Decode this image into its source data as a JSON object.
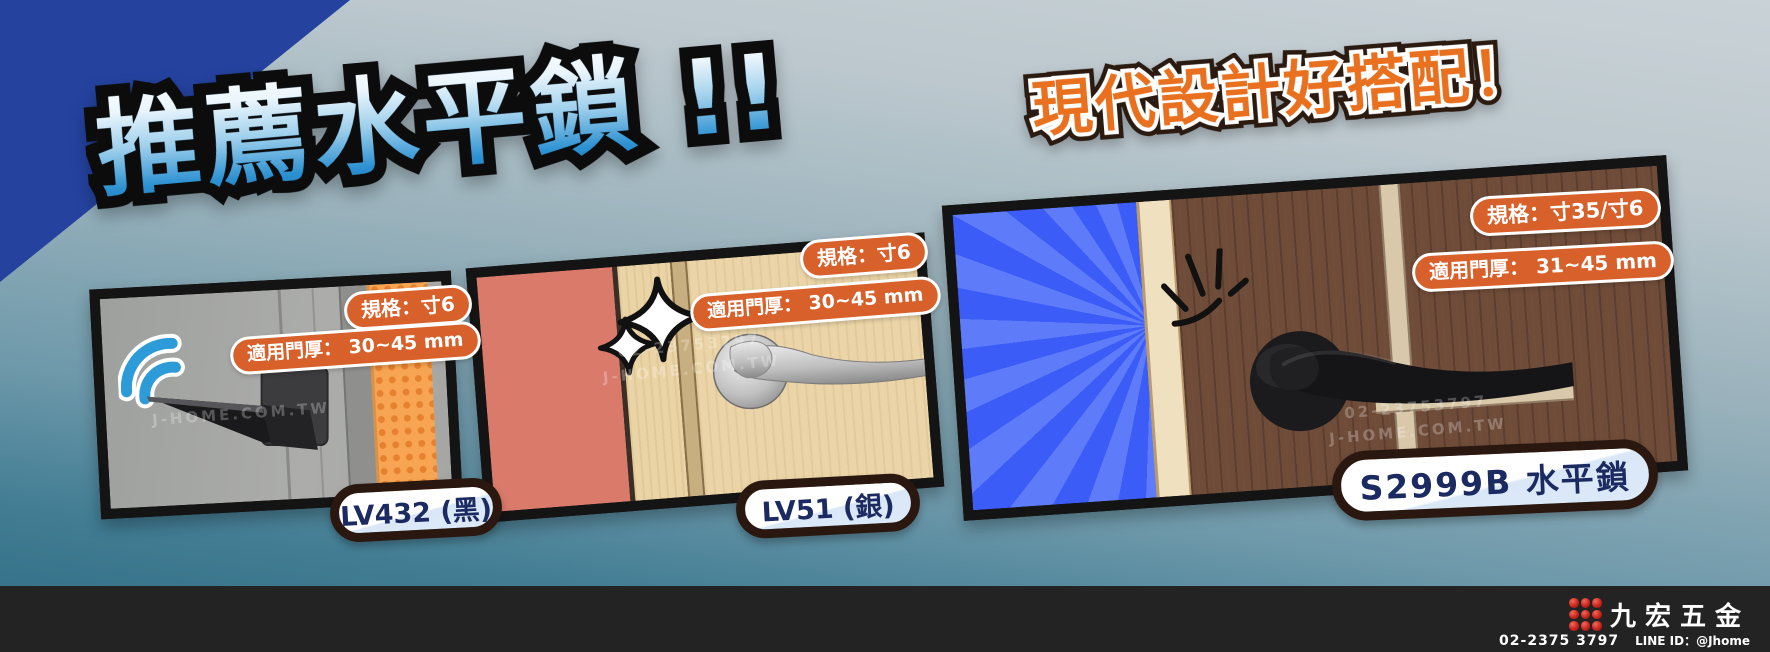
{
  "colors": {
    "background_top": "#C9D2D7",
    "background_bottom": "#2E6B82",
    "corner_triangle": "#24429E",
    "headline_blue": "#2E92D2",
    "subtitle_orange": "#E8701E",
    "badge_orange": "#D7602B",
    "panel_border": "#141414",
    "pill_border": "#2A1710",
    "pill_text_navy": "#1B2A60",
    "footer_background": "#232323",
    "logo_red": "#C9251C",
    "sunburst_blue": "#3B5CF6",
    "signal_blue": "#2D9BD8"
  },
  "headline": {
    "text": "推薦水平鎖 !!"
  },
  "subtitle": {
    "text": "現代設計好搭配！"
  },
  "watermark": {
    "line1": "02-23753797",
    "line2": "J-HOME.COM.TW"
  },
  "panels": [
    {
      "product": "LV432",
      "label": "LV432 (黑)",
      "spec_badge": "規格：寸6",
      "thickness_badge": "適用門厚： 30~45 mm"
    },
    {
      "product": "LV51",
      "label": "LV51 (銀)",
      "spec_badge": "規格：寸6",
      "thickness_badge": "適用門厚： 30~45 mm"
    },
    {
      "product": "S2999B",
      "label": "S2999B 水平鎖",
      "spec_badge": "規格：寸35/寸6",
      "thickness_badge": "適用門厚： 31~45 mm"
    }
  ],
  "footer": {
    "brand": "九宏五金",
    "phone": "02-2375 3797",
    "line_id": "LINE ID：@Jhome"
  }
}
